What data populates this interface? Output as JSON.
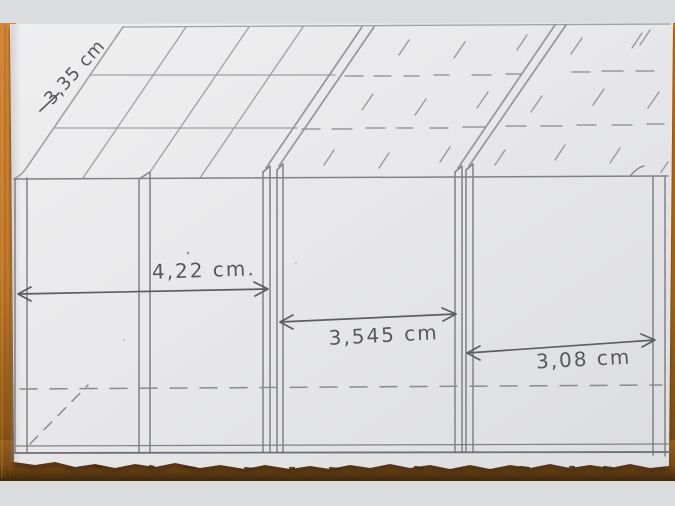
{
  "scene": {
    "description": "Hand-drawn pencil sketch of a building facade: hatched roof above three wall sections separated by double posts, with dimension arrows",
    "medium": "pencil on torn-edge paper photographed on a wooden table"
  },
  "measurements": {
    "unit": "cm",
    "roof_slope": {
      "label": "3,35 cm",
      "orientation": "diagonal-along-roof-edge"
    },
    "left_section": {
      "label": "4,22 cm.",
      "orientation": "horizontal"
    },
    "middle_section": {
      "label": "3,545 cm",
      "orientation": "horizontal"
    },
    "right_section": {
      "label": "3,08 cm",
      "orientation": "horizontal"
    }
  },
  "colors": {
    "background_strip": "#dbdcde",
    "table_wood_light": "#d28536",
    "table_wood_mid": "#b4722c",
    "table_wood_dark": "#4a2f0e",
    "paper_light": "#efeff0",
    "paper_dark": "#dcdde0",
    "pencil_light": "#97989c",
    "pencil_mid": "#808186",
    "pencil_dark": "#5c5d62"
  }
}
